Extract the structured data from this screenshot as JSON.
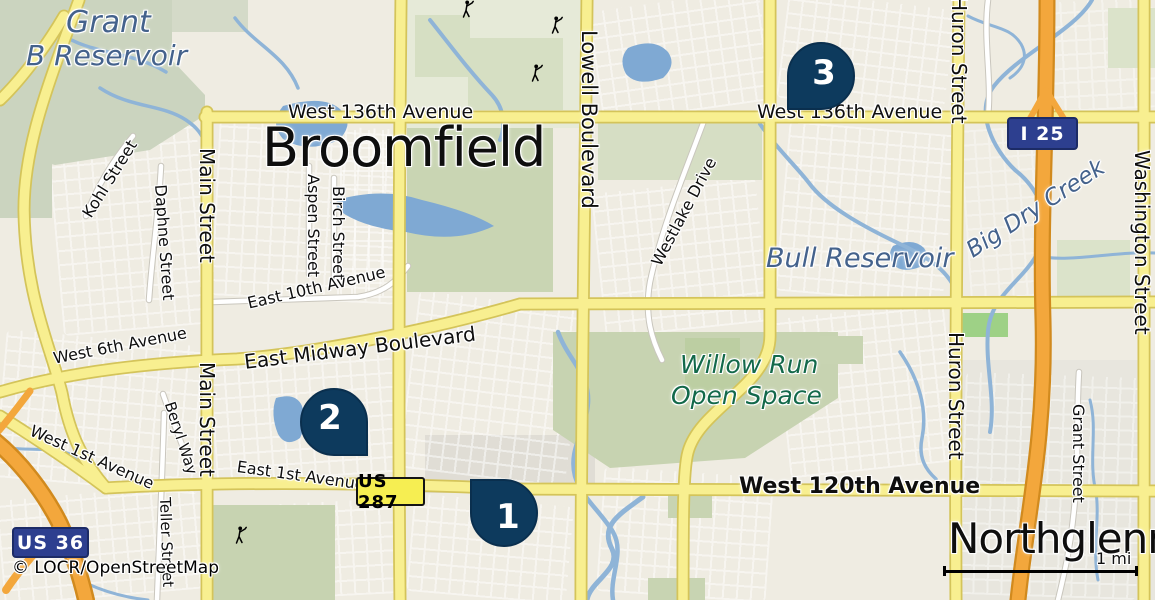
{
  "map": {
    "attribution": {
      "text": "© LOCR/OpenStreetMap",
      "x": 12,
      "y": 560
    },
    "scale": {
      "label": "1 mi",
      "x": 943,
      "y": 566,
      "width": 189,
      "label_x": 1096,
      "label_y": 551
    },
    "colors": {
      "background": "#efece2",
      "road_yellow": "#f8ef90",
      "road_yellow_casing": "#d4c45a",
      "motorway_orange": "#f3a73c",
      "motorway_casing": "#d18a1e",
      "water": "#8fb4d7",
      "water_fill": "#7fa9d3",
      "green_area": "#c9d5b3",
      "marker_navy": "#0d3a5d",
      "shield_blue": "#2d3f8f",
      "shield_yellow": "#f6ee52",
      "water_text": "#44628c",
      "green_text": "#13694a"
    },
    "markers": [
      {
        "n": "1",
        "x": 470,
        "y": 479,
        "corner": "tl"
      },
      {
        "n": "2",
        "x": 300,
        "y": 388,
        "corner": "br"
      },
      {
        "n": "3",
        "x": 787,
        "y": 42,
        "corner": "bl"
      }
    ],
    "shields": [
      {
        "text": "I 25",
        "x": 1007,
        "y": 117,
        "w": 71,
        "h": 33,
        "style": "interstate"
      },
      {
        "text": "US 36",
        "x": 12,
        "y": 527,
        "w": 77,
        "h": 31,
        "style": "interstate"
      },
      {
        "text": "US 287",
        "x": 356,
        "y": 477,
        "w": 69,
        "h": 29,
        "style": "us"
      }
    ],
    "labels": [
      {
        "text": "Grant",
        "x": 66,
        "y": 8,
        "rot": 0,
        "size": 30,
        "cls": "water-lg"
      },
      {
        "text": "B Reservoir",
        "x": 26,
        "y": 42,
        "rot": 0,
        "size": 28,
        "cls": "water-lg"
      },
      {
        "text": "Broomfield",
        "x": 262,
        "y": 121,
        "rot": 0,
        "size": 54,
        "cls": "city"
      },
      {
        "text": "West 136th Avenue",
        "x": 288,
        "y": 103,
        "rot": 0,
        "size": 19,
        "cls": "road"
      },
      {
        "text": "West 136th Avenue",
        "x": 757,
        "y": 103,
        "rot": 0,
        "size": 19,
        "cls": "road"
      },
      {
        "text": "Lowell Boulevard",
        "x": 599,
        "y": 30,
        "rot": 90,
        "size": 21,
        "cls": "road"
      },
      {
        "text": "Huron Street",
        "x": 969,
        "y": -4,
        "rot": 90,
        "size": 20,
        "cls": "road"
      },
      {
        "text": "Huron Street",
        "x": 966,
        "y": 332,
        "rot": 90,
        "size": 20,
        "cls": "road"
      },
      {
        "text": "Washington Street",
        "x": 1152,
        "y": 150,
        "rot": 90,
        "size": 20,
        "cls": "road"
      },
      {
        "text": "Main Street",
        "x": 217,
        "y": 148,
        "rot": 90,
        "size": 20,
        "cls": "road"
      },
      {
        "text": "Main Street",
        "x": 217,
        "y": 362,
        "rot": 90,
        "size": 20,
        "cls": "road"
      },
      {
        "text": "Kohl Street",
        "x": 80,
        "y": 212,
        "rot": -58,
        "size": 16,
        "cls": "road"
      },
      {
        "text": "Daphne Street",
        "x": 168,
        "y": 184,
        "rot": 86,
        "size": 16,
        "cls": "road"
      },
      {
        "text": "Aspen Street",
        "x": 321,
        "y": 174,
        "rot": 90,
        "size": 16,
        "cls": "road"
      },
      {
        "text": "Birch Street",
        "x": 346,
        "y": 186,
        "rot": 90,
        "size": 16,
        "cls": "road"
      },
      {
        "text": "Westlake Drive",
        "x": 649,
        "y": 261,
        "rot": -62,
        "size": 16,
        "cls": "road"
      },
      {
        "text": "East 10th Avenue",
        "x": 246,
        "y": 296,
        "rot": -13,
        "size": 16,
        "cls": "road"
      },
      {
        "text": "East Midway Boulevard",
        "x": 243,
        "y": 352,
        "rot": -7,
        "size": 20,
        "cls": "road"
      },
      {
        "text": "West 6th Avenue",
        "x": 52,
        "y": 351,
        "rot": -11,
        "size": 16,
        "cls": "road"
      },
      {
        "text": "West 1st Avenue",
        "x": 34,
        "y": 423,
        "rot": 24,
        "size": 16,
        "cls": "road"
      },
      {
        "text": "East 1st Avenue",
        "x": 238,
        "y": 459,
        "rot": 8,
        "size": 16,
        "cls": "road"
      },
      {
        "text": "Beryl Way",
        "x": 176,
        "y": 400,
        "rot": 72,
        "size": 15,
        "cls": "road"
      },
      {
        "text": "Teller Street",
        "x": 172,
        "y": 497,
        "rot": 88,
        "size": 15,
        "cls": "road"
      },
      {
        "text": "Grant Street",
        "x": 1086,
        "y": 404,
        "rot": 90,
        "size": 16,
        "cls": "road"
      },
      {
        "text": "Bull Reservoir",
        "x": 766,
        "y": 245,
        "rot": 0,
        "size": 27,
        "cls": "water-lg"
      },
      {
        "text": "Big Dry Creek",
        "x": 963,
        "y": 243,
        "rot": -33,
        "size": 23,
        "cls": "water"
      },
      {
        "text": "Willow Run",
        "x": 680,
        "y": 352,
        "rot": 0,
        "size": 25,
        "cls": "green"
      },
      {
        "text": "Open Space",
        "x": 671,
        "y": 383,
        "rot": 0,
        "size": 25,
        "cls": "green"
      },
      {
        "text": "West 120th Avenue",
        "x": 739,
        "y": 476,
        "rot": 0,
        "size": 22,
        "cls": "road-bold"
      },
      {
        "text": "Northglenn",
        "x": 948,
        "y": 518,
        "rot": 0,
        "size": 42,
        "cls": "city"
      }
    ],
    "golfer_icons": [
      {
        "x": 459,
        "y": 0
      },
      {
        "x": 548,
        "y": 16
      },
      {
        "x": 528,
        "y": 64
      },
      {
        "x": 232,
        "y": 526
      }
    ]
  }
}
